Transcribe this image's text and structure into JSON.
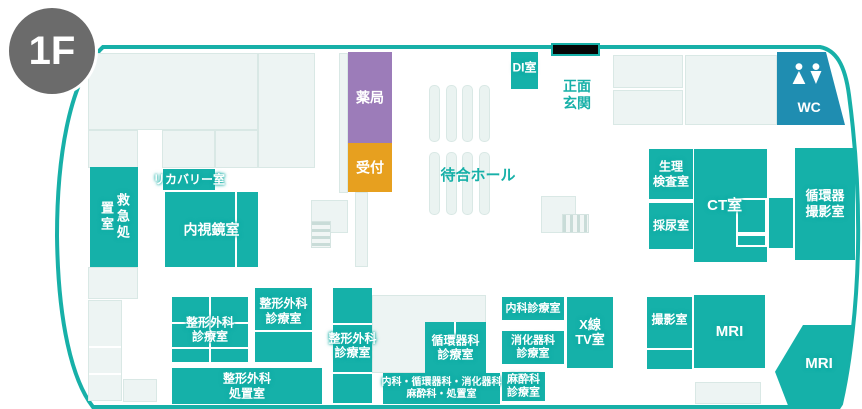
{
  "floor": {
    "badge": "1F"
  },
  "colors": {
    "room_teal": "#15b1a9",
    "outline_teal": "#17b0a8",
    "wc_blue": "#1f8db1",
    "pharmacy_purple": "#9c7cb9",
    "reception_orange": "#e7a01f",
    "light_room": "#edf4f3",
    "badge_gray": "#6b6b6b"
  },
  "areas": {
    "pharmacy": "薬局",
    "reception": "受付",
    "di_room": "DI室",
    "main_entrance": [
      "正面",
      "玄関"
    ],
    "waiting_hall": "待合ホール",
    "wc": "WC",
    "emergency_room": "救急処置室",
    "recovery_room": "リカバリー室",
    "endoscopy_room": "内視鏡室",
    "physiology_lab": [
      "生理",
      "検査室"
    ],
    "urine_room": "採尿室",
    "ct_room": "CT室",
    "cardio_imaging_room": [
      "循環器",
      "撮影室"
    ],
    "ortho_clinic_a": [
      "整形外科",
      "診療室"
    ],
    "ortho_clinic_b": [
      "整形外科",
      "診療室"
    ],
    "ortho_clinic_c": [
      "整形外科",
      "診療室"
    ],
    "ortho_treatment_room": [
      "整形外科",
      "処置室"
    ],
    "cardiology_clinic": [
      "循環器科",
      "診療室"
    ],
    "internal_clinic": "内科診療室",
    "gastro_clinic": [
      "消化器科",
      "診療室"
    ],
    "anesthesia_clinic": [
      "麻酔科",
      "診療室"
    ],
    "multi_treatment_room": [
      "内科・循環器科・消化器科",
      "麻酔科・処置室"
    ],
    "xray_tv_room": [
      "X線",
      "TV室"
    ],
    "imaging_room": "撮影室",
    "mri_room": "MRI",
    "mri_room_2": "MRI"
  }
}
